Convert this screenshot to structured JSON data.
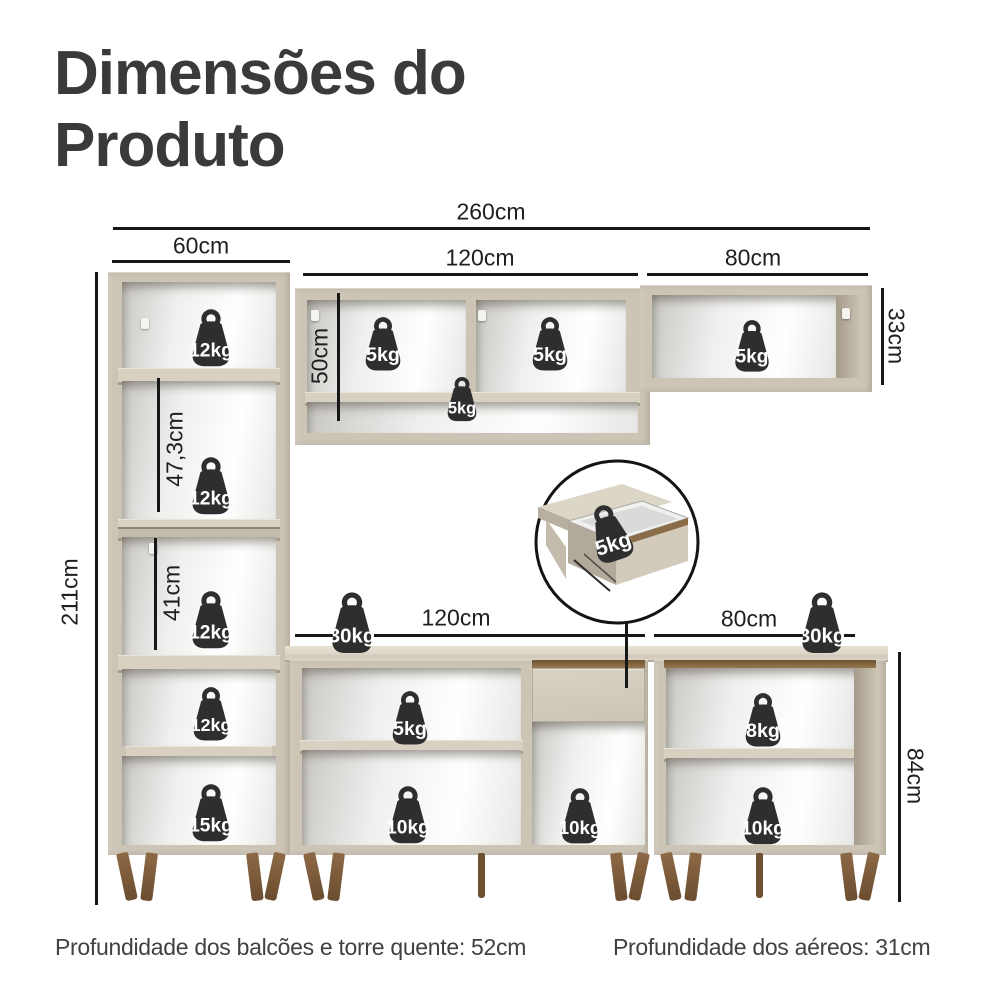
{
  "title": "Dimensões do Produto",
  "footer": {
    "left": "Profundidade dos balcões e torre quente: 52cm",
    "right": "Profundidade dos aéreos: 31cm"
  },
  "colors": {
    "cabinet_body": "#ccc5b6",
    "cabinet_top": "#e6e1d3",
    "interior_back": "#f2f2f1",
    "handle_groove_brown": "#8a6c48",
    "wood_leg": "#7a5839",
    "weight_badge": "#2e2e2e",
    "dimension_line": "#171717",
    "title_text": "#3a3a3a"
  },
  "dimensions": [
    {
      "name": "total-width",
      "label": "260cm",
      "line": {
        "x": 113,
        "y": 227,
        "len": 757,
        "dir": "h"
      },
      "text": {
        "x": 491,
        "y": 212,
        "rot": 0
      }
    },
    {
      "name": "tower-width",
      "label": "60cm",
      "line": {
        "x": 112,
        "y": 260,
        "len": 178,
        "dir": "h"
      },
      "text": {
        "x": 201,
        "y": 246,
        "rot": 0
      }
    },
    {
      "name": "upper-middle-width",
      "label": "120cm",
      "line": {
        "x": 303,
        "y": 273,
        "len": 335,
        "dir": "h"
      },
      "text": {
        "x": 480,
        "y": 258,
        "rot": 0
      }
    },
    {
      "name": "upper-right-width",
      "label": "80cm",
      "line": {
        "x": 647,
        "y": 273,
        "len": 221,
        "dir": "h"
      },
      "text": {
        "x": 753,
        "y": 258,
        "rot": 0
      }
    },
    {
      "name": "upper-right-height",
      "label": "33cm",
      "line": {
        "x": 881,
        "y": 288,
        "len": 97,
        "dir": "v"
      },
      "text": {
        "x": 896,
        "y": 336,
        "rot": 90
      }
    },
    {
      "name": "upper-middle-height",
      "label": "50cm",
      "line": {
        "x": 337,
        "y": 293,
        "len": 128,
        "dir": "v"
      },
      "text": {
        "x": 320,
        "y": 356,
        "rot": -90
      }
    },
    {
      "name": "tower-upper-section",
      "label": "47,3cm",
      "line": {
        "x": 157,
        "y": 378,
        "len": 134,
        "dir": "v"
      },
      "text": {
        "x": 175,
        "y": 449,
        "rot": -90
      }
    },
    {
      "name": "tower-lower-section",
      "label": "41cm",
      "line": {
        "x": 154,
        "y": 538,
        "len": 112,
        "dir": "v"
      },
      "text": {
        "x": 172,
        "y": 593,
        "rot": -90
      }
    },
    {
      "name": "total-height",
      "label": "211cm",
      "line": {
        "x": 95,
        "y": 272,
        "len": 633,
        "dir": "v"
      },
      "text": {
        "x": 70,
        "y": 592,
        "rot": -90
      }
    },
    {
      "name": "counter-middle-width",
      "label": "120cm",
      "line": {
        "x": 295,
        "y": 634,
        "len": 350,
        "dir": "h"
      },
      "text": {
        "x": 456,
        "y": 618,
        "rot": 0
      }
    },
    {
      "name": "counter-right-width",
      "label": "80cm",
      "line": {
        "x": 654,
        "y": 634,
        "len": 201,
        "dir": "h"
      },
      "text": {
        "x": 749,
        "y": 619,
        "rot": 0
      }
    },
    {
      "name": "counter-height",
      "label": "84cm",
      "line": {
        "x": 898,
        "y": 652,
        "len": 250,
        "dir": "v"
      },
      "text": {
        "x": 915,
        "y": 776,
        "rot": 90
      }
    }
  ],
  "weights": [
    {
      "label": "12kg",
      "x": 211,
      "y": 340,
      "size": 62
    },
    {
      "label": "12kg",
      "x": 211,
      "y": 488,
      "size": 62
    },
    {
      "label": "12kg",
      "x": 211,
      "y": 622,
      "size": 62
    },
    {
      "label": "12kg",
      "x": 211,
      "y": 716,
      "size": 58
    },
    {
      "label": "15kg",
      "x": 211,
      "y": 815,
      "size": 62
    },
    {
      "label": "5kg",
      "x": 383,
      "y": 346,
      "size": 58
    },
    {
      "label": "5kg",
      "x": 550,
      "y": 346,
      "size": 58
    },
    {
      "label": "5kg",
      "x": 462,
      "y": 401,
      "size": 48
    },
    {
      "label": "5kg",
      "x": 752,
      "y": 348,
      "size": 56
    },
    {
      "label": "5kg",
      "x": 610,
      "y": 535,
      "size": 62,
      "rot": -18
    },
    {
      "label": "30kg",
      "x": 352,
      "y": 625,
      "size": 66
    },
    {
      "label": "30kg",
      "x": 822,
      "y": 625,
      "size": 66
    },
    {
      "label": "5kg",
      "x": 410,
      "y": 720,
      "size": 58
    },
    {
      "label": "10kg",
      "x": 408,
      "y": 817,
      "size": 62
    },
    {
      "label": "10kg",
      "x": 580,
      "y": 818,
      "size": 60
    },
    {
      "label": "8kg",
      "x": 763,
      "y": 722,
      "size": 58
    },
    {
      "label": "10kg",
      "x": 763,
      "y": 818,
      "size": 62
    }
  ]
}
